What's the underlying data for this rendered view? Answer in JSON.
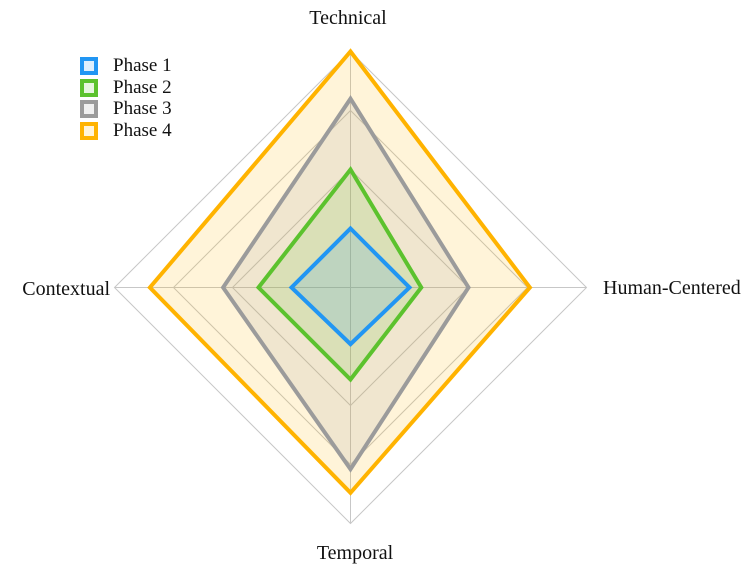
{
  "figure": {
    "background": "#ffffff"
  },
  "chart_data": {
    "type": "radar",
    "axes": [
      "Technical",
      "Human-Centered",
      "Temporal",
      "Contextual"
    ],
    "axes_order": "top, right, bottom, left",
    "scale": {
      "min": 0,
      "max": 1.0,
      "gridlines": [
        0.25,
        0.5,
        0.75,
        1.0
      ]
    },
    "grid_color": "#c7c7c7",
    "spoke_color": "#c7c7c7",
    "fill_opacity": 0.15,
    "stroke_width": 4,
    "legend_position": "upper-left",
    "series": [
      {
        "name": "Phase 1",
        "color": "#2196f3",
        "values": [
          0.25,
          0.25,
          0.24,
          0.25
        ]
      },
      {
        "name": "Phase 2",
        "color": "#5cc22e",
        "values": [
          0.5,
          0.3,
          0.39,
          0.39
        ]
      },
      {
        "name": "Phase 3",
        "color": "#9b9b9b",
        "values": [
          0.8,
          0.5,
          0.77,
          0.54
        ]
      },
      {
        "name": "Phase 4",
        "color": "#ffb300",
        "values": [
          1.0,
          0.76,
          0.87,
          0.85
        ]
      }
    ]
  }
}
